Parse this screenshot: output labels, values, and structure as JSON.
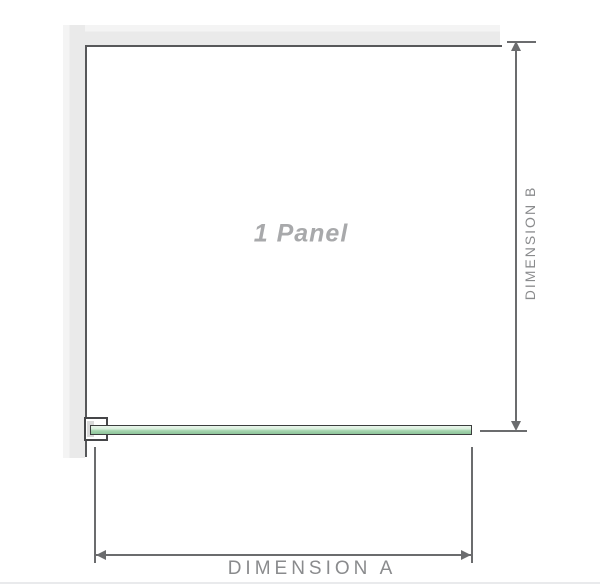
{
  "diagram": {
    "panel_label": "1 Panel",
    "dimension_a_label": "DIMENSION A",
    "dimension_b_label": "DIMENSION B"
  },
  "colors": {
    "wall_gray": "#eaeaea",
    "wall_highlight": "#f4f4f4",
    "outline_dark": "#57585a",
    "glass_green_light": "#eaf6ec",
    "glass_green_dark": "#8fc69b",
    "glass_border": "#3c3d3e",
    "bracket_border": "#454648",
    "bracket_pad": "#d9d9d9",
    "dimension_line_gray": "#6b6c6e",
    "dimension_label_gray": "#8a8b8d",
    "panel_label_gray": "#a8a9ab",
    "bottom_edge_gray": "#e9eaec"
  }
}
